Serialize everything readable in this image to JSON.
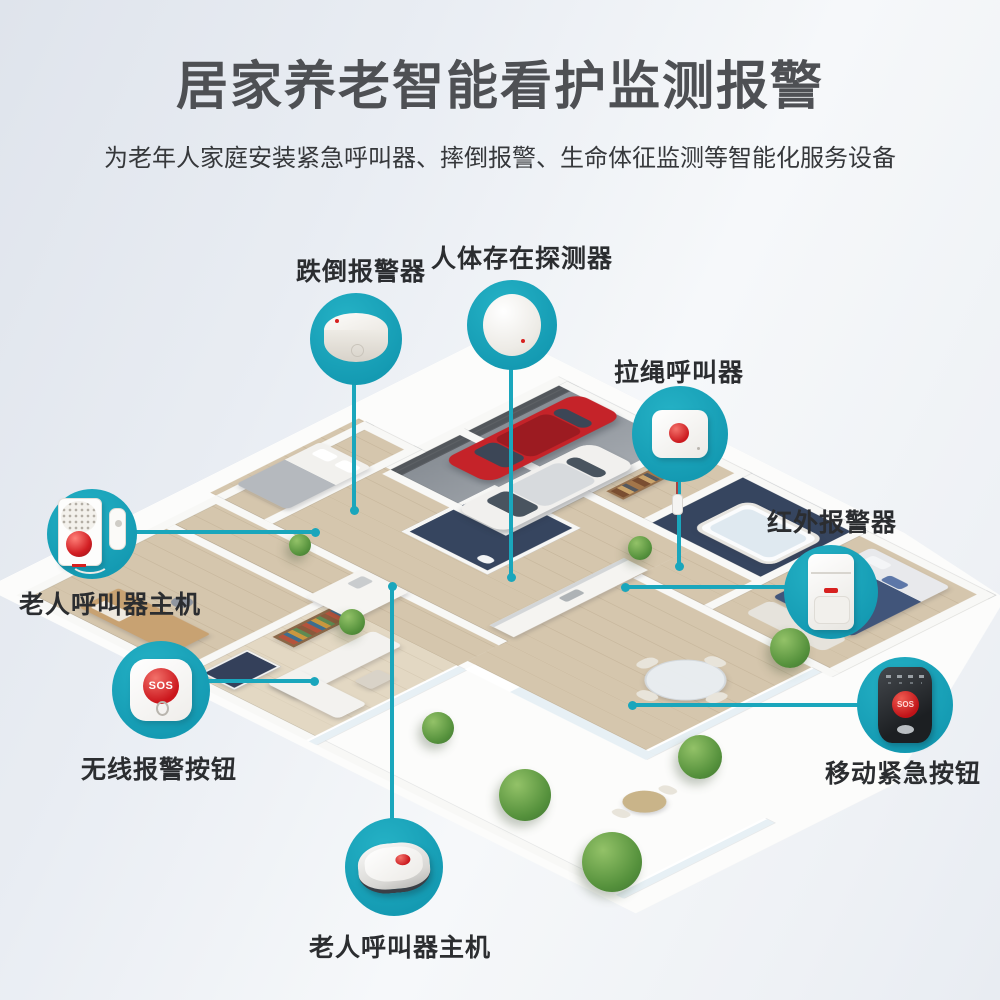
{
  "header": {
    "title": "居家养老智能看护监测报警",
    "subtitle": "为老年人家庭安装紧急呼叫器、摔倒报警、生命体征监测等智能化服务设备"
  },
  "theme": {
    "accent_teal": "#1aa6bc",
    "alert_red": "#d7201f",
    "title_gray": "#4e5054"
  },
  "callouts": {
    "fall_alarm": {
      "label": "跌倒报警器",
      "device": "fall-alarm-sensor"
    },
    "presence_detector": {
      "label": "人体存在探测器",
      "device": "human-presence-sensor"
    },
    "pull_cord": {
      "label": "拉绳呼叫器",
      "device": "pull-cord-caller"
    },
    "infrared": {
      "label": "红外报警器",
      "device": "infrared-pir-sensor"
    },
    "host_left": {
      "label": "老人呼叫器主机",
      "device": "caller-host-wall-unit"
    },
    "wireless_button": {
      "label": "无线报警按钮",
      "device": "wireless-sos-button",
      "button_text": "SOS"
    },
    "mobile_button": {
      "label": "移动紧急按钮",
      "device": "mobile-sos-pendant",
      "button_text": "SOS"
    },
    "host_bottom": {
      "label": "老人呼叫器主机",
      "device": "caller-host-hub"
    }
  }
}
